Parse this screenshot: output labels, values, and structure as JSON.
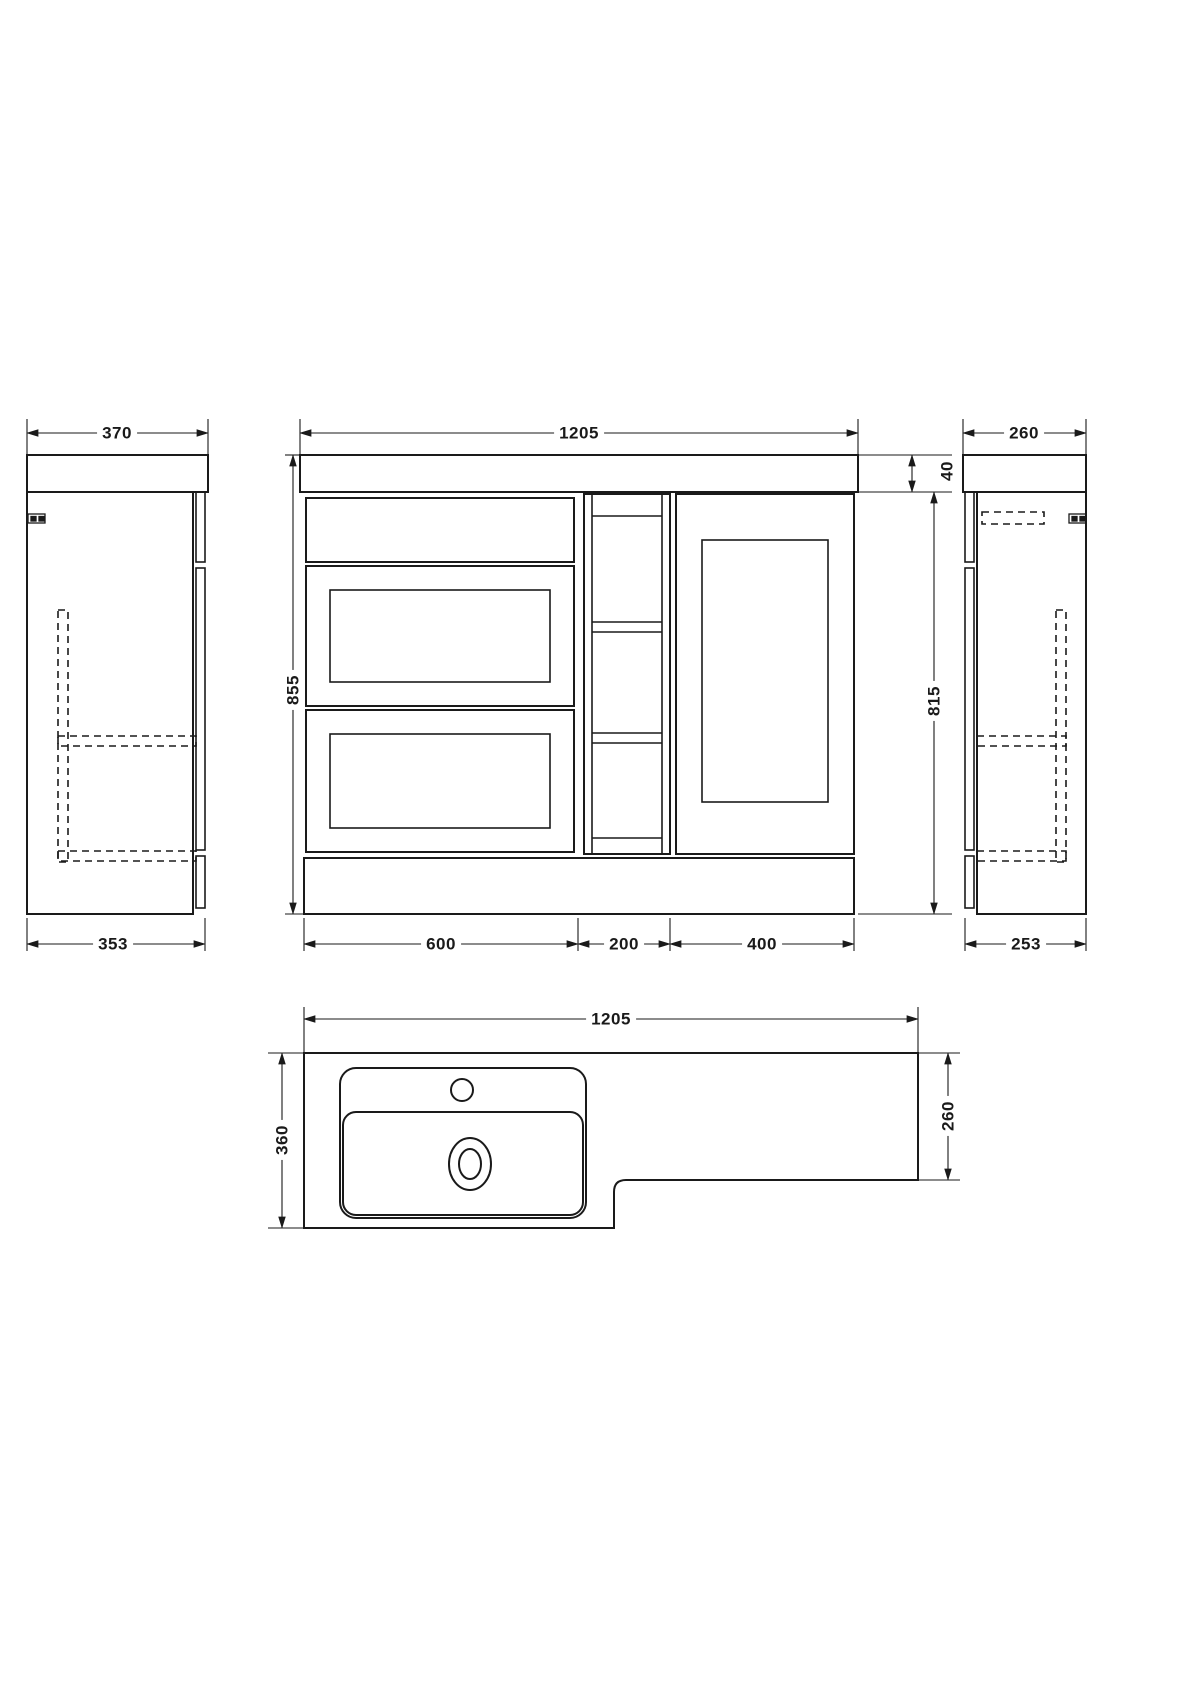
{
  "drawing": {
    "type": "bathroom-furniture-technical-drawing",
    "colors": {
      "line": "#1a1a1a",
      "background": "#ffffff"
    },
    "dims": {
      "left": {
        "top": "370",
        "bottom": "353"
      },
      "front": {
        "width": "1205",
        "height": "855",
        "worktop": "40",
        "cabinet_height": "815",
        "basin_unit": "600",
        "mid_unit": "200",
        "wc_unit": "400"
      },
      "right": {
        "top": "260",
        "bottom": "253"
      },
      "plan": {
        "width": "1205",
        "left_depth": "360",
        "right_depth": "260"
      }
    }
  }
}
